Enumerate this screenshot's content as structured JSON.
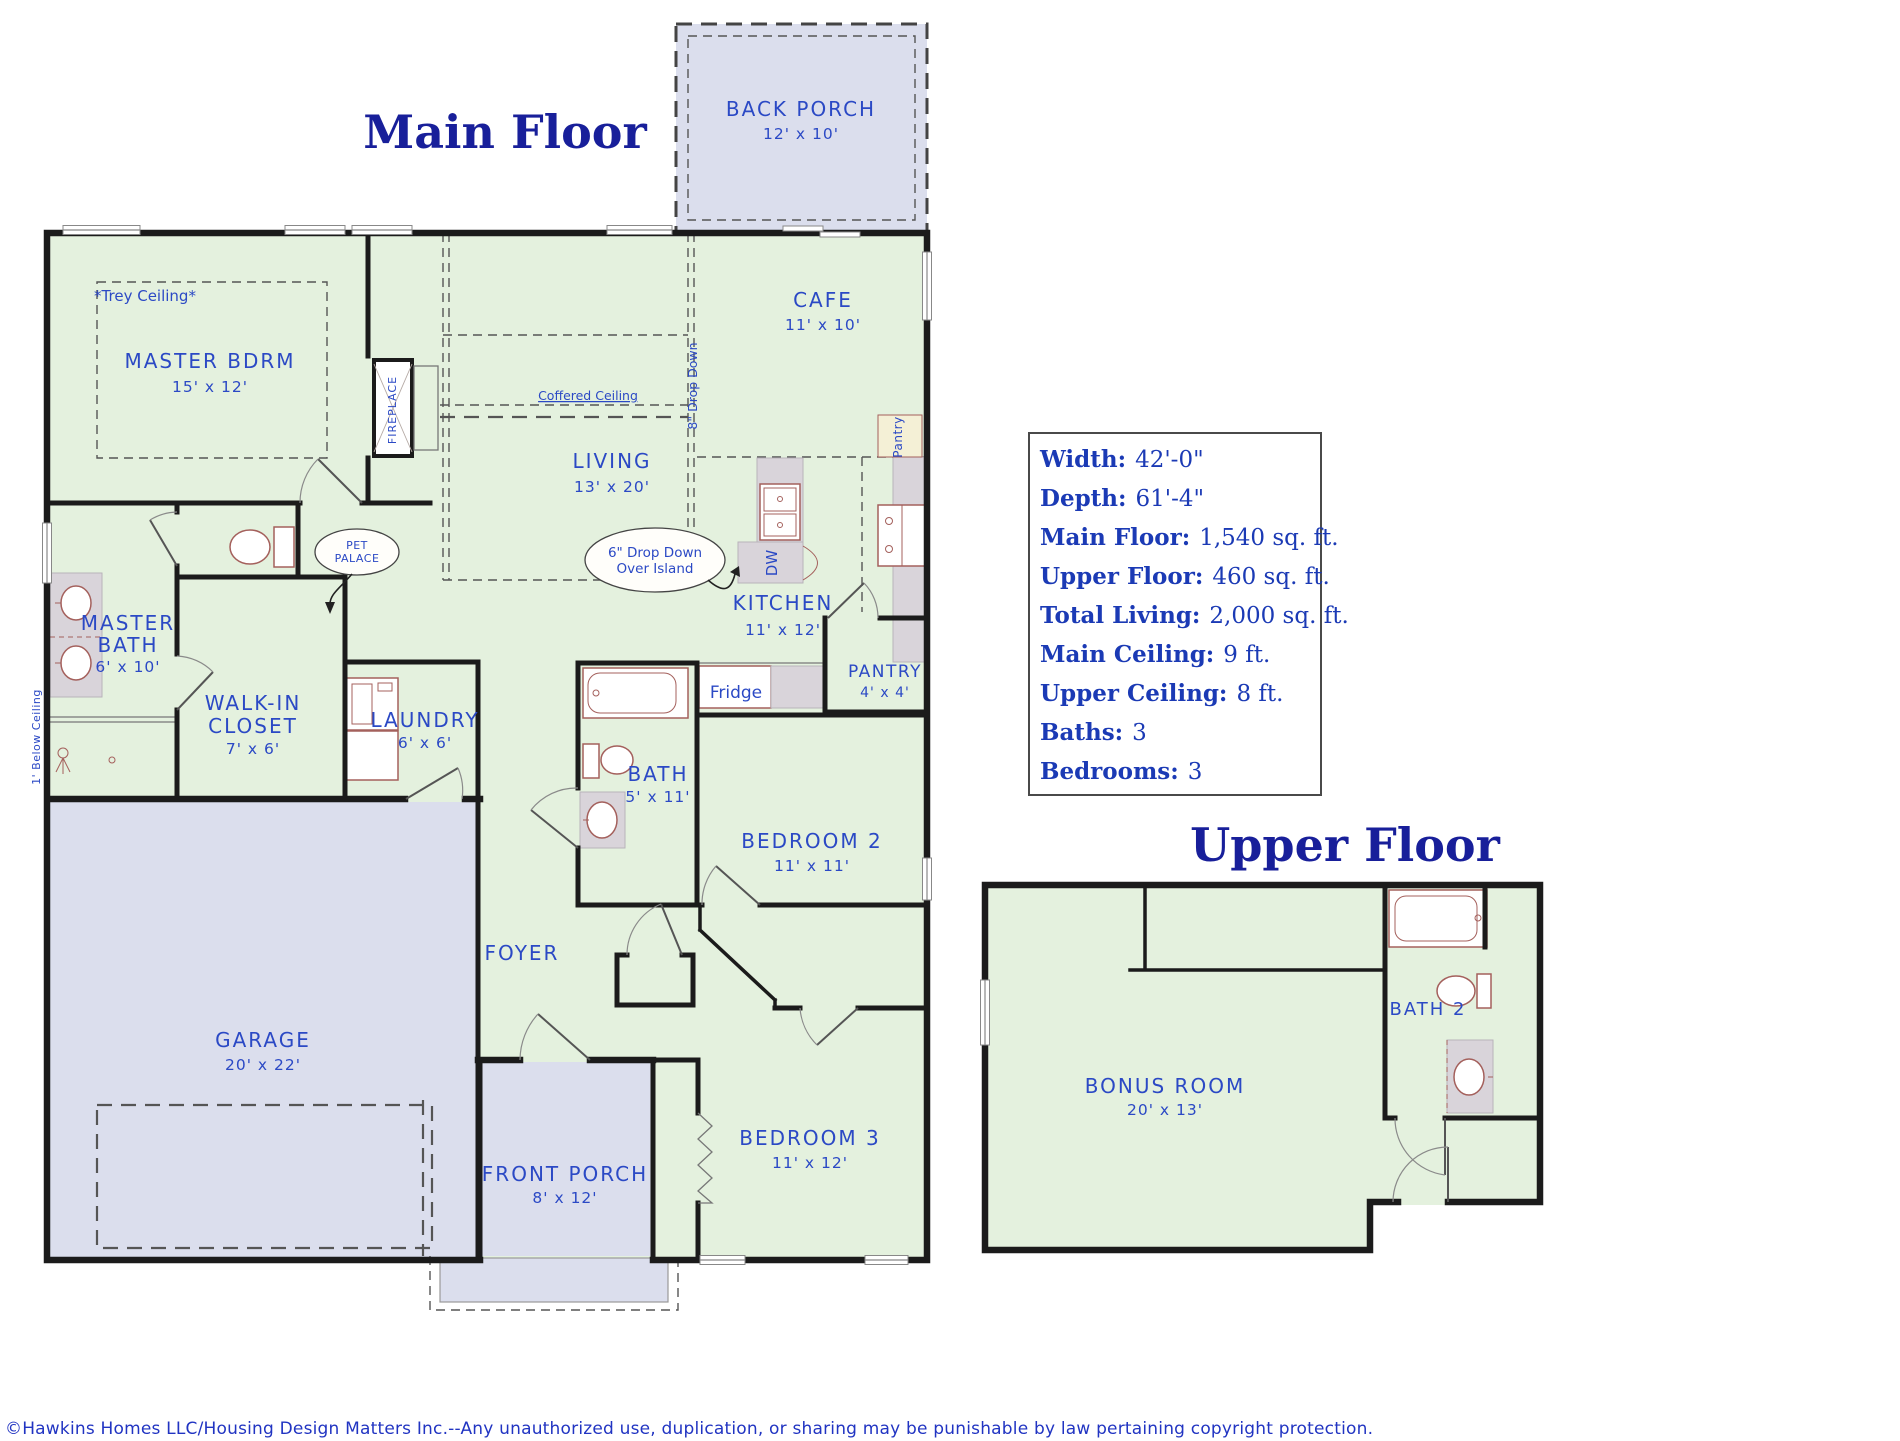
{
  "titles": {
    "main_floor": "Main Floor",
    "upper_floor": "Upper Floor"
  },
  "specs": {
    "rows": [
      {
        "label": "Width:",
        "value": "42'-0\""
      },
      {
        "label": "Depth:",
        "value": "61'-4\""
      },
      {
        "label": "Main Floor:",
        "value": "1,540 sq. ft."
      },
      {
        "label": "Upper Floor:",
        "value": "460 sq. ft."
      },
      {
        "label": "Total Living:",
        "value": "2,000 sq. ft."
      },
      {
        "label": "Main Ceiling:",
        "value": "9 ft."
      },
      {
        "label": "Upper Ceiling:",
        "value": "8 ft."
      },
      {
        "label": "Baths:",
        "value": "3"
      },
      {
        "label": "Bedrooms:",
        "value": "3"
      }
    ]
  },
  "rooms": {
    "back_porch": {
      "name": "BACK PORCH",
      "dims": "12' x 10'"
    },
    "cafe": {
      "name": "CAFE",
      "dims": "11' x 10'"
    },
    "master_bdrm": {
      "name": "MASTER BDRM",
      "dims": "15' x 12'"
    },
    "living": {
      "name": "LIVING",
      "dims": "13' x 20'"
    },
    "kitchen": {
      "name": "KITCHEN",
      "dims": "11' x 12'"
    },
    "master_bath": {
      "line1": "MASTER",
      "line2": "BATH",
      "dims": "6' x 10'"
    },
    "walk_in_closet": {
      "line1": "WALK-IN",
      "line2": "CLOSET",
      "dims": "7' x 6'"
    },
    "laundry": {
      "name": "LAUNDRY",
      "dims": "6' x 6'"
    },
    "bath": {
      "name": "BATH",
      "dims": "5' x 11'"
    },
    "bedroom2": {
      "name": "BEDROOM 2",
      "dims": "11' x 11'"
    },
    "foyer": {
      "name": "FOYER"
    },
    "bedroom3": {
      "name": "BEDROOM 3",
      "dims": "11' x 12'"
    },
    "front_porch": {
      "name": "FRONT PORCH",
      "dims": "8' x 12'"
    },
    "garage": {
      "name": "GARAGE",
      "dims": "20' x 22'"
    },
    "pantry": {
      "name": "PANTRY",
      "dims": "4' x 4'"
    },
    "bonus_room": {
      "name": "BONUS ROOM",
      "dims": "20' x 13'"
    },
    "bath2": {
      "name": "BATH 2"
    }
  },
  "annotations": {
    "trey_ceiling": "*Trey Ceiling*",
    "coffered_ceiling": "Coffered Ceiling",
    "drop_down_8": "8\" Drop Down",
    "drop_down_island_1": "6\" Drop Down",
    "drop_down_island_2": "Over Island",
    "pet_palace_1": "PET",
    "pet_palace_2": "PALACE",
    "below_ceiling": "1' Below Ceiling",
    "fireplace": "FIREPLACE",
    "pantry_cabinet": "Pantry",
    "fridge": "Fridge",
    "dishwasher": "DW"
  },
  "footer": {
    "copyright": "©Hawkins Homes LLC/Housing Design Matters Inc.--Any unauthorized use, duplication, or sharing may be punishable by law pertaining copyright protection."
  },
  "colors": {
    "room_fill": "#e4f1de",
    "porch_fill": "#dbdeed",
    "wall": "#1b1b1b",
    "label_blue": "#2b49c5",
    "title_navy": "#181f9a",
    "fixture_brown": "#a4605c",
    "counter_gray": "#d9d4da",
    "pantry_cream": "#f4f0d6"
  }
}
